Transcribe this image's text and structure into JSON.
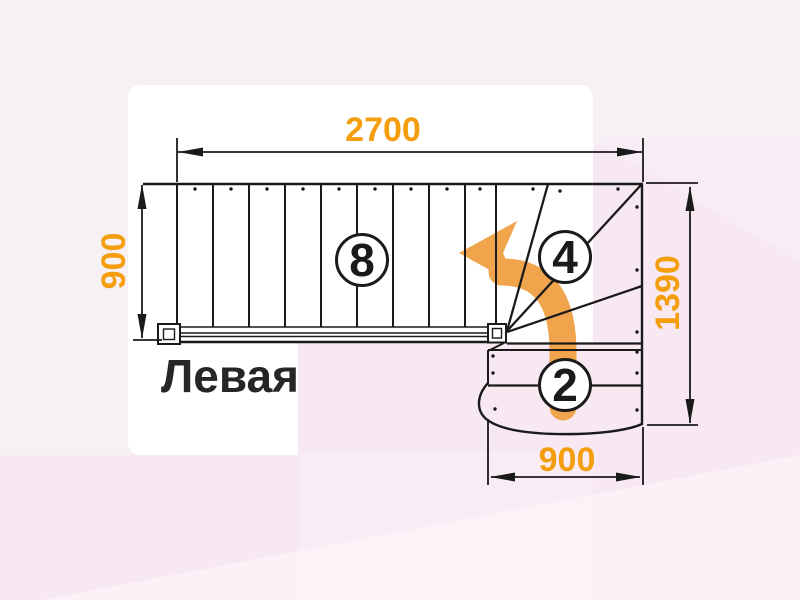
{
  "diagram": {
    "title": "Левая",
    "dimensions": {
      "top_width": "2700",
      "left_height": "900",
      "right_height": "1390",
      "bottom_width": "900"
    },
    "counts": {
      "straight_steps": "8",
      "winder_steps": "4",
      "lower_steps": "2"
    },
    "colors": {
      "dimension_text": "#F49E0E",
      "direction_arrow": "#F0A44C",
      "drawing_lines": "#1a1a1a",
      "background_base": "#F7F1F6",
      "background_pink": "#F8E8F2",
      "drawing_background": "#FFFFFF"
    }
  }
}
